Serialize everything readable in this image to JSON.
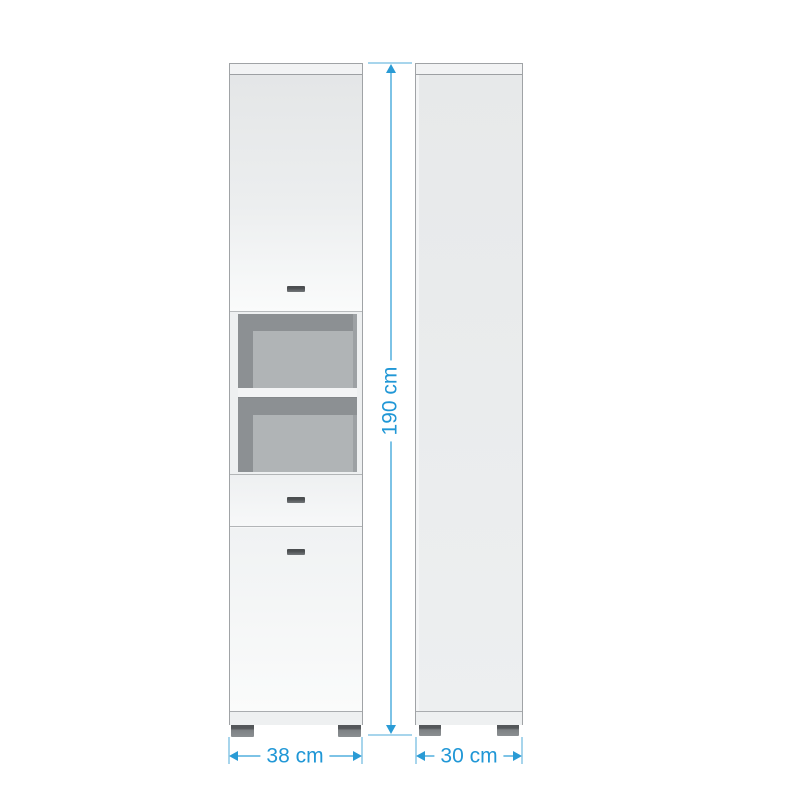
{
  "annotations": {
    "height": "190 cm",
    "width": "38 cm",
    "depth": "30 cm"
  },
  "colors": {
    "dimension_text": "#2097d6",
    "dimension_line": "#7dc3e6",
    "dimension_tick": "#a7d5ec",
    "arrow": "#2a9bd5",
    "cabinet_edge": "#a0a3a6",
    "cabinet_face_top": "#e4e6e7",
    "cabinet_face_bottom": "#fafbfb",
    "side_panel": "#e7e9ea",
    "niche_shadow": "#8c9093",
    "niche_back_panel": "#b0b4b6",
    "shelf": "#f3f4f5",
    "handle": "#4b4e50",
    "foot": "#7e8285",
    "background": "#ffffff"
  }
}
